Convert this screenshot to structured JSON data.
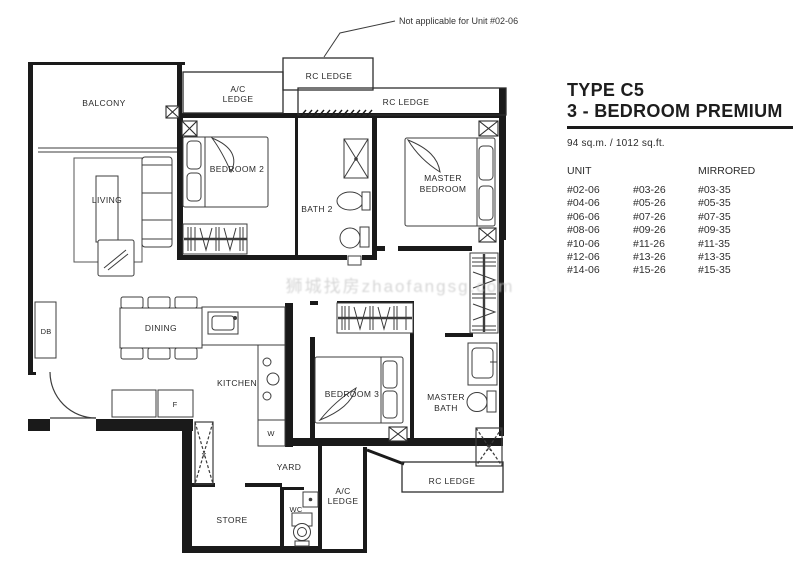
{
  "colors": {
    "ink": "#1a1a1a",
    "furniture_line": "#3c3c3c",
    "watermark": "#c9c9c9",
    "background": "#ffffff"
  },
  "plan": {
    "labels": {
      "balcony": "BALCONY",
      "ac_ledge": [
        "A/C",
        "LEDGE"
      ],
      "rc_ledge": "RC LEDGE",
      "living": "LIVING",
      "bedroom2": "BEDROOM 2",
      "bath2": "BATH 2",
      "master_bedroom": [
        "MASTER",
        "BEDROOM"
      ],
      "bedroom3": "BEDROOM 3",
      "master_bath": [
        "MASTER",
        "BATH"
      ],
      "dining": "DINING",
      "kitchen": "KITCHEN",
      "yard": "YARD",
      "store": "STORE",
      "wc": "WC",
      "db": "DB",
      "fridge": "F",
      "washer": "W",
      "shaft": "X",
      "note": "Not applicable for Unit #02-06"
    },
    "watermark": "狮城找房zhaofangsg.com"
  },
  "panel": {
    "type_title": "TYPE C5",
    "subtitle": "3 - BEDROOM PREMIUM",
    "area": "94 sq.m. / 1012 sq.ft.",
    "col_unit": "UNIT",
    "col_mirrored": "MIRRORED",
    "units": [
      [
        "#02-06",
        "#03-26",
        "#03-35"
      ],
      [
        "#04-06",
        "#05-26",
        "#05-35"
      ],
      [
        "#06-06",
        "#07-26",
        "#07-35"
      ],
      [
        "#08-06",
        "#09-26",
        "#09-35"
      ],
      [
        "#10-06",
        "#11-26",
        "#11-35"
      ],
      [
        "#12-06",
        "#13-26",
        "#13-35"
      ],
      [
        "#14-06",
        "#15-26",
        "#15-35"
      ]
    ]
  }
}
